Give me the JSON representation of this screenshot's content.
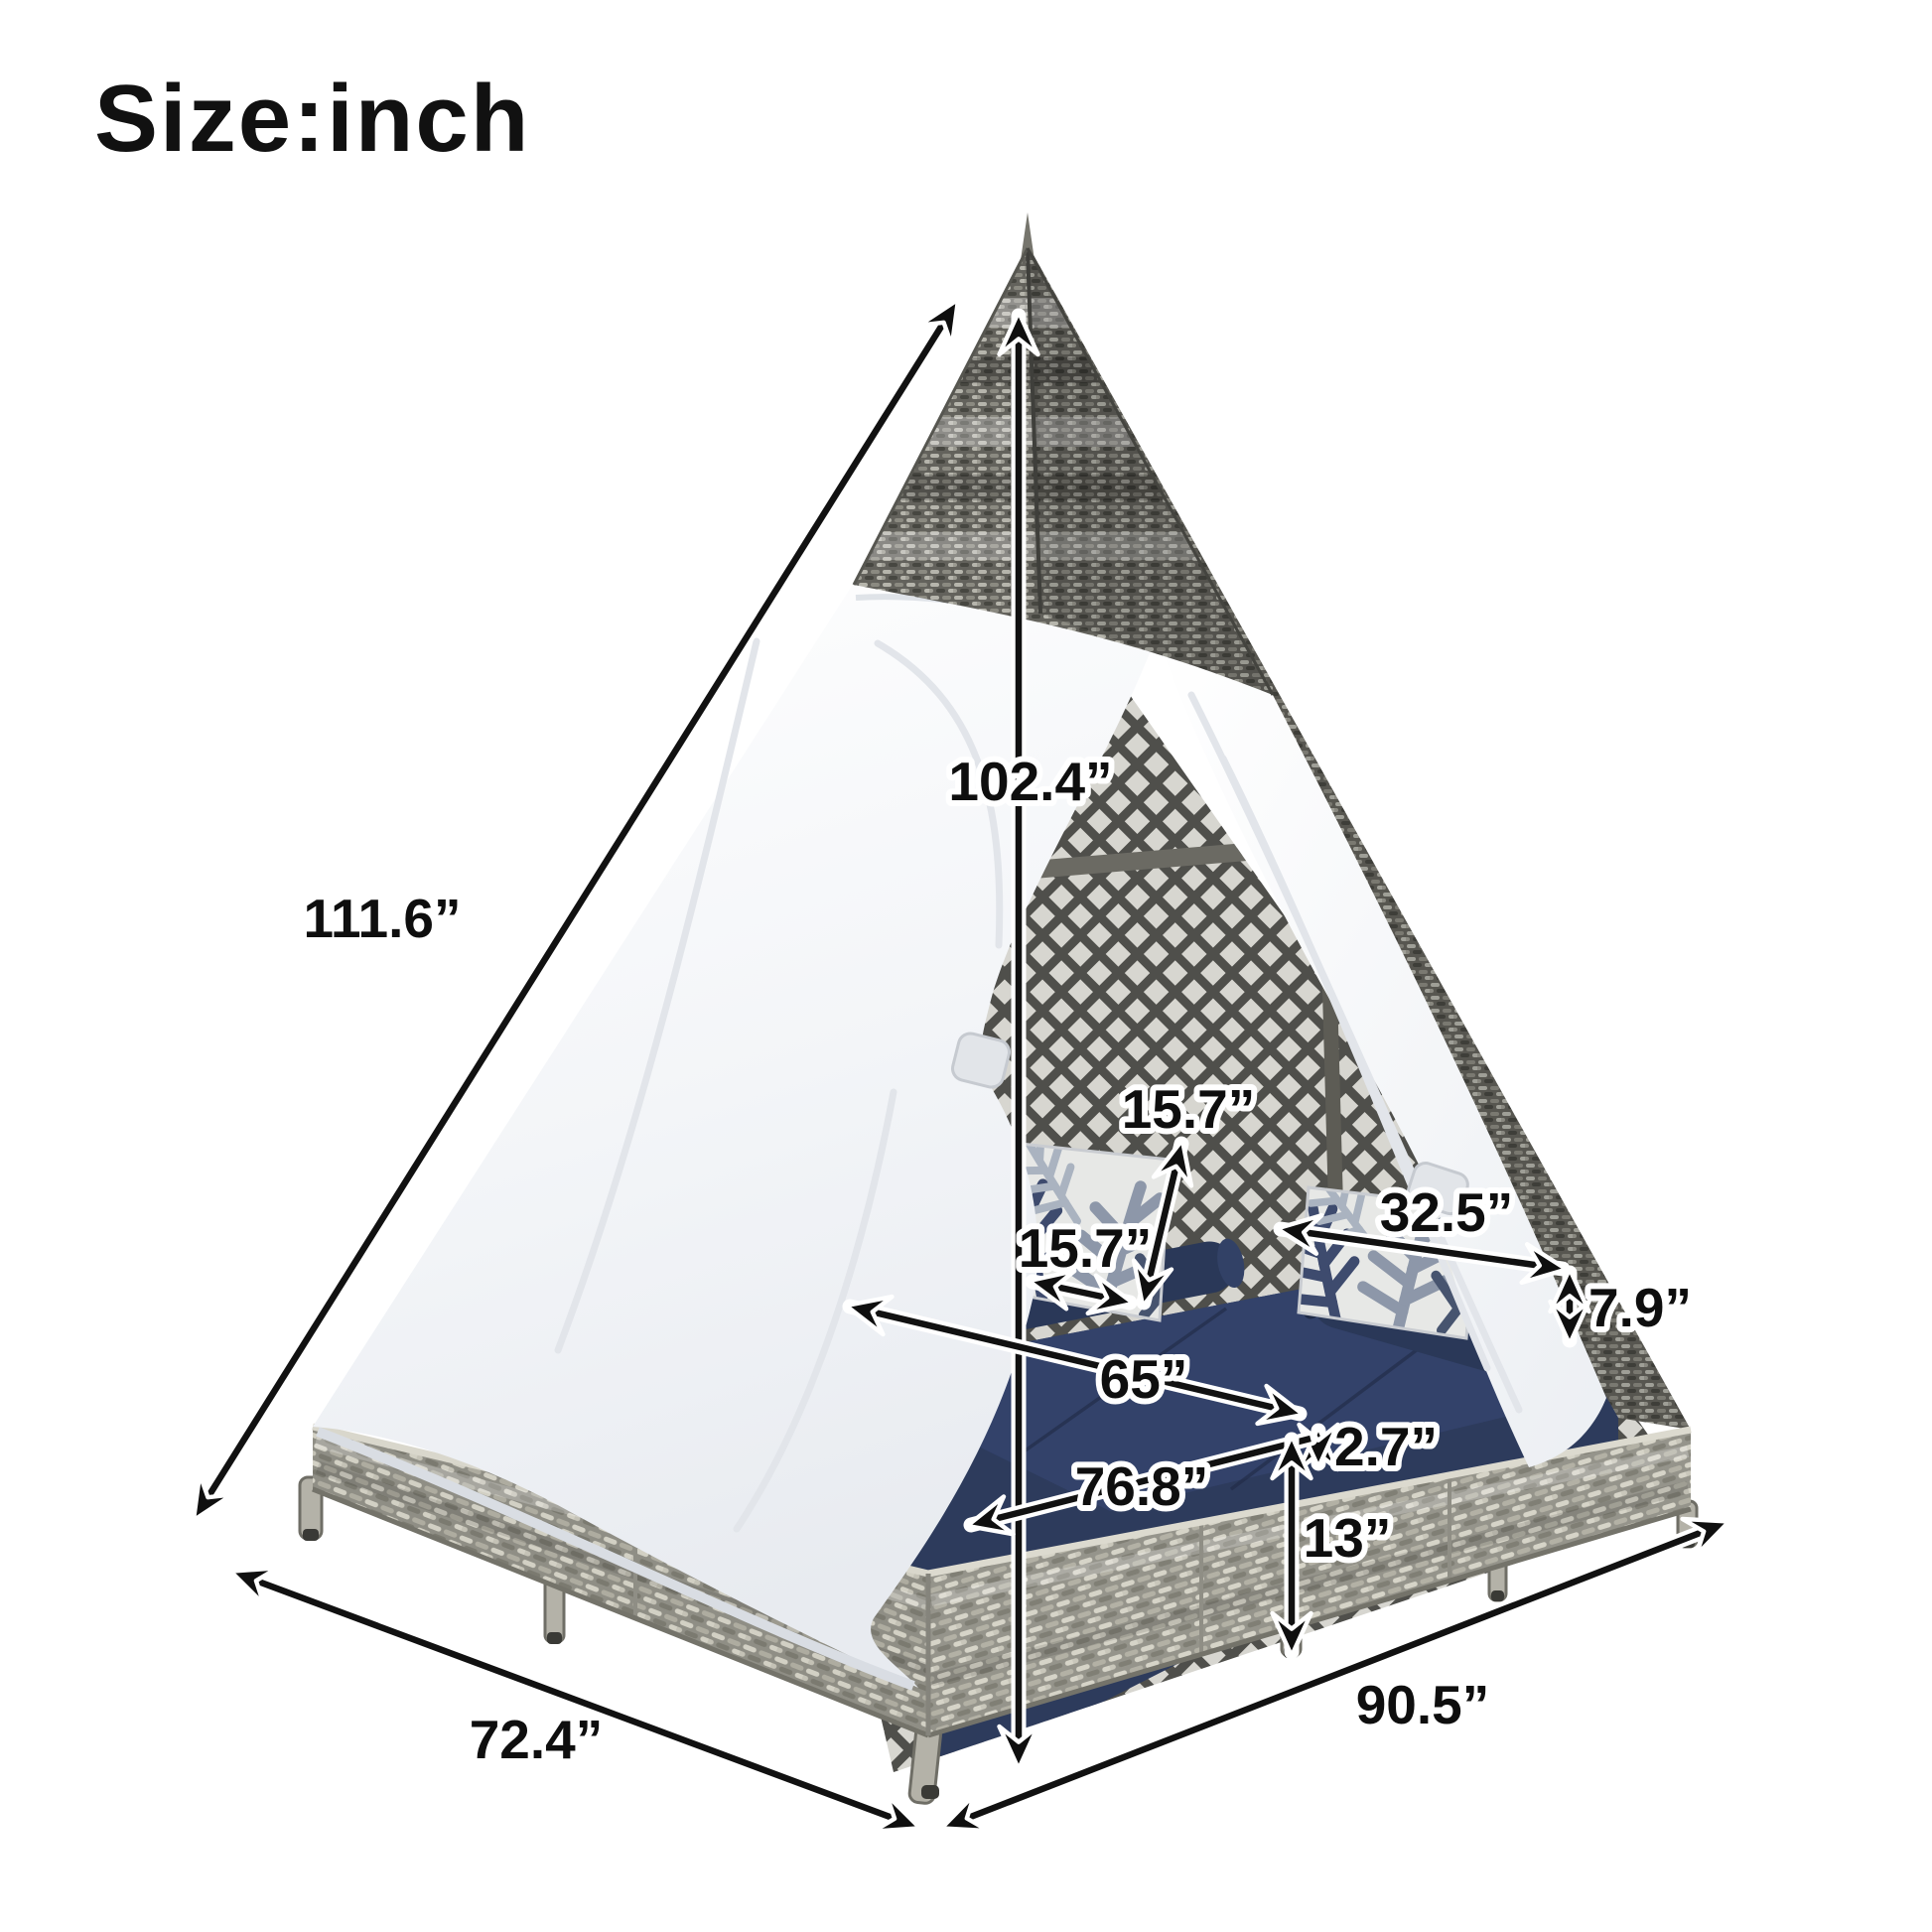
{
  "title": "Size:inch",
  "unit": "inch",
  "dimensions": {
    "slant_height": {
      "label": "111.6”",
      "value": 111.6
    },
    "peak_height": {
      "label": "102.4”",
      "value": 102.4
    },
    "pillow_height": {
      "label": "15.7”",
      "value": 15.7
    },
    "pillow_width": {
      "label": "15.7”",
      "value": 15.7
    },
    "back_cushion_length": {
      "label": "32.5”",
      "value": 32.5
    },
    "back_cushion_height": {
      "label": "7.9”",
      "value": 7.9
    },
    "mattress_length": {
      "label": "65”",
      "value": 65
    },
    "pad_thickness": {
      "label": "2.7”",
      "value": 2.7
    },
    "mattress_depth": {
      "label": "76.8”",
      "value": 76.8
    },
    "base_height": {
      "label": "13”",
      "value": 13
    },
    "base_side_left": {
      "label": "72.4”",
      "value": 72.4
    },
    "base_side_front": {
      "label": "90.5”",
      "value": 90.5
    }
  },
  "colors": {
    "line": "#111111",
    "halo": "#ffffff",
    "navy_cushion": "#2d3b5c",
    "wicker_gray": "#a8a69b",
    "canvas_white": "#f6f7f9"
  }
}
